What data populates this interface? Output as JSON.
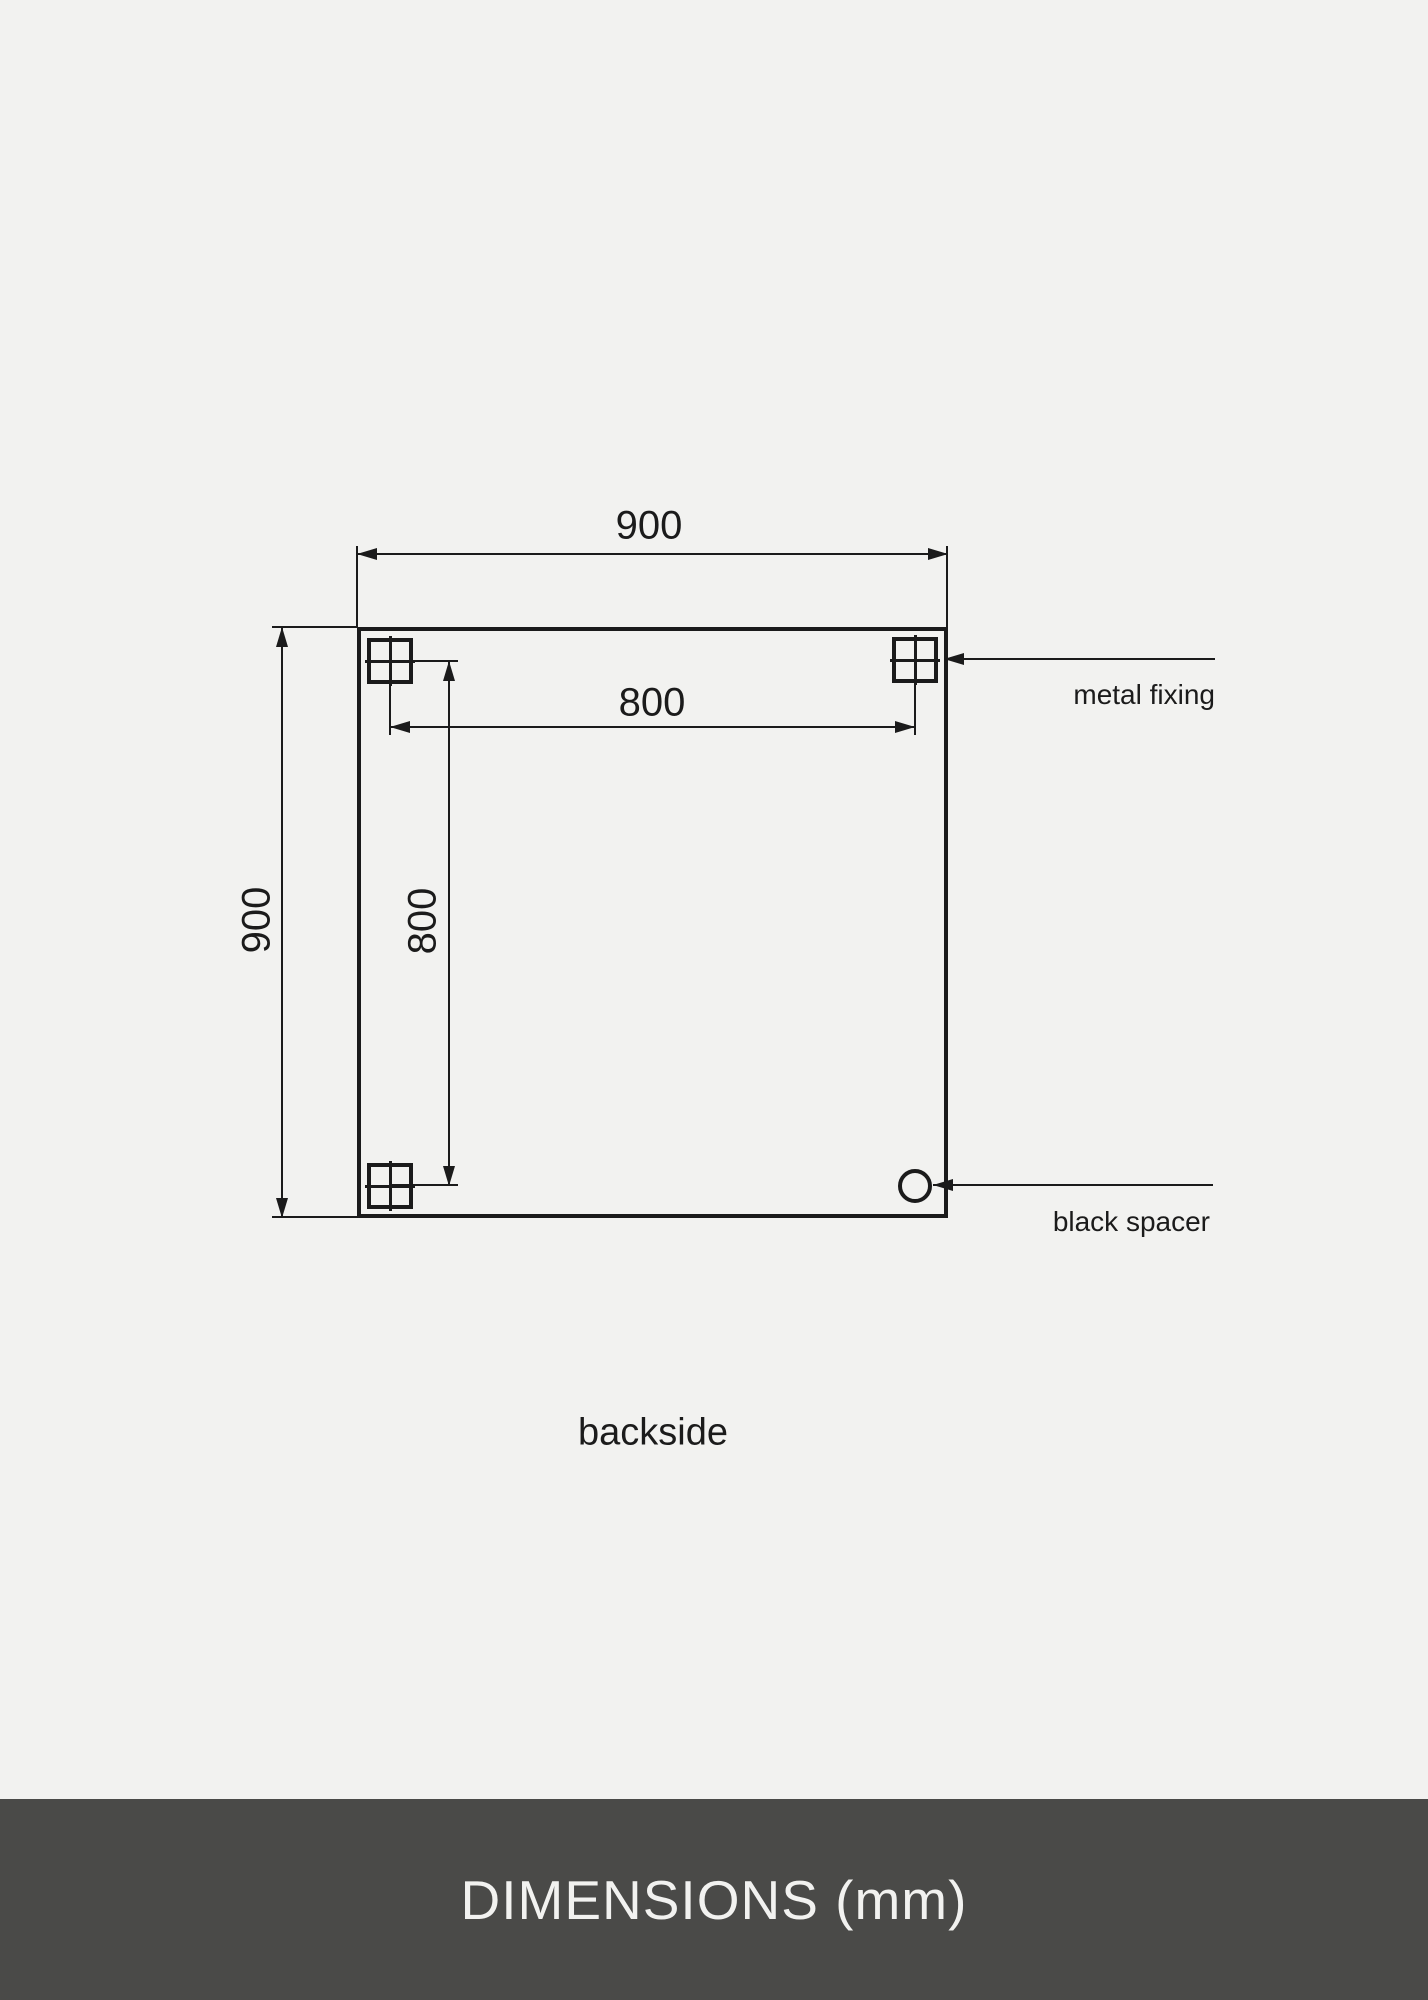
{
  "colors": {
    "background": "#f2f2f0",
    "ink": "#1b1b1b",
    "footer_bg": "#4a4a48",
    "footer_text": "#f2f2f0"
  },
  "drawing": {
    "view_label": "backside",
    "overall_width_mm": "900",
    "overall_height_mm": "900",
    "fixing_span_horizontal_mm": "800",
    "fixing_span_vertical_mm": "800",
    "callouts": {
      "metal_fixing": "metal fixing",
      "black_spacer": "black spacer"
    }
  },
  "footer": {
    "title": "DIMENSIONS (mm)"
  }
}
